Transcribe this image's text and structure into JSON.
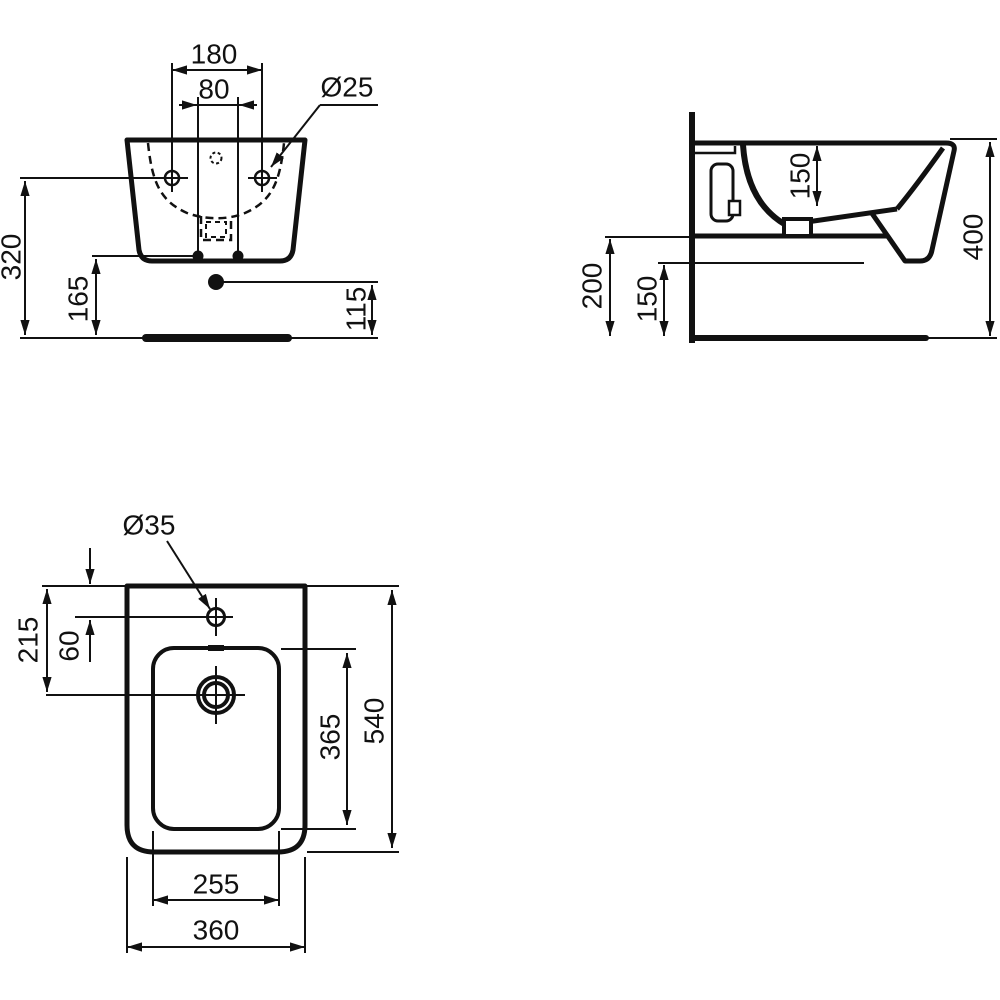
{
  "colors": {
    "ink": "#111111",
    "background": "#ffffff"
  },
  "front_view": {
    "labels": {
      "hole_spacing": "180",
      "fixing_bolt_spacing": "80",
      "fixing_hole_diameter": "Ø25",
      "fixing_holes_height": "320",
      "body_bottom_height": "165",
      "waste_outlet_height": "115"
    }
  },
  "side_view": {
    "labels": {
      "bowl_depth": "150",
      "overall_height": "400",
      "underside_height": "200",
      "front_underside_height": "150"
    }
  },
  "top_view": {
    "labels": {
      "tap_hole_diameter": "Ø35",
      "drain_center_from_rear_edge": "215",
      "tap_hole_from_rear_edge": "60",
      "inner_bowl_length": "365",
      "overall_length": "540",
      "inner_bowl_width": "255",
      "overall_width": "360"
    }
  }
}
